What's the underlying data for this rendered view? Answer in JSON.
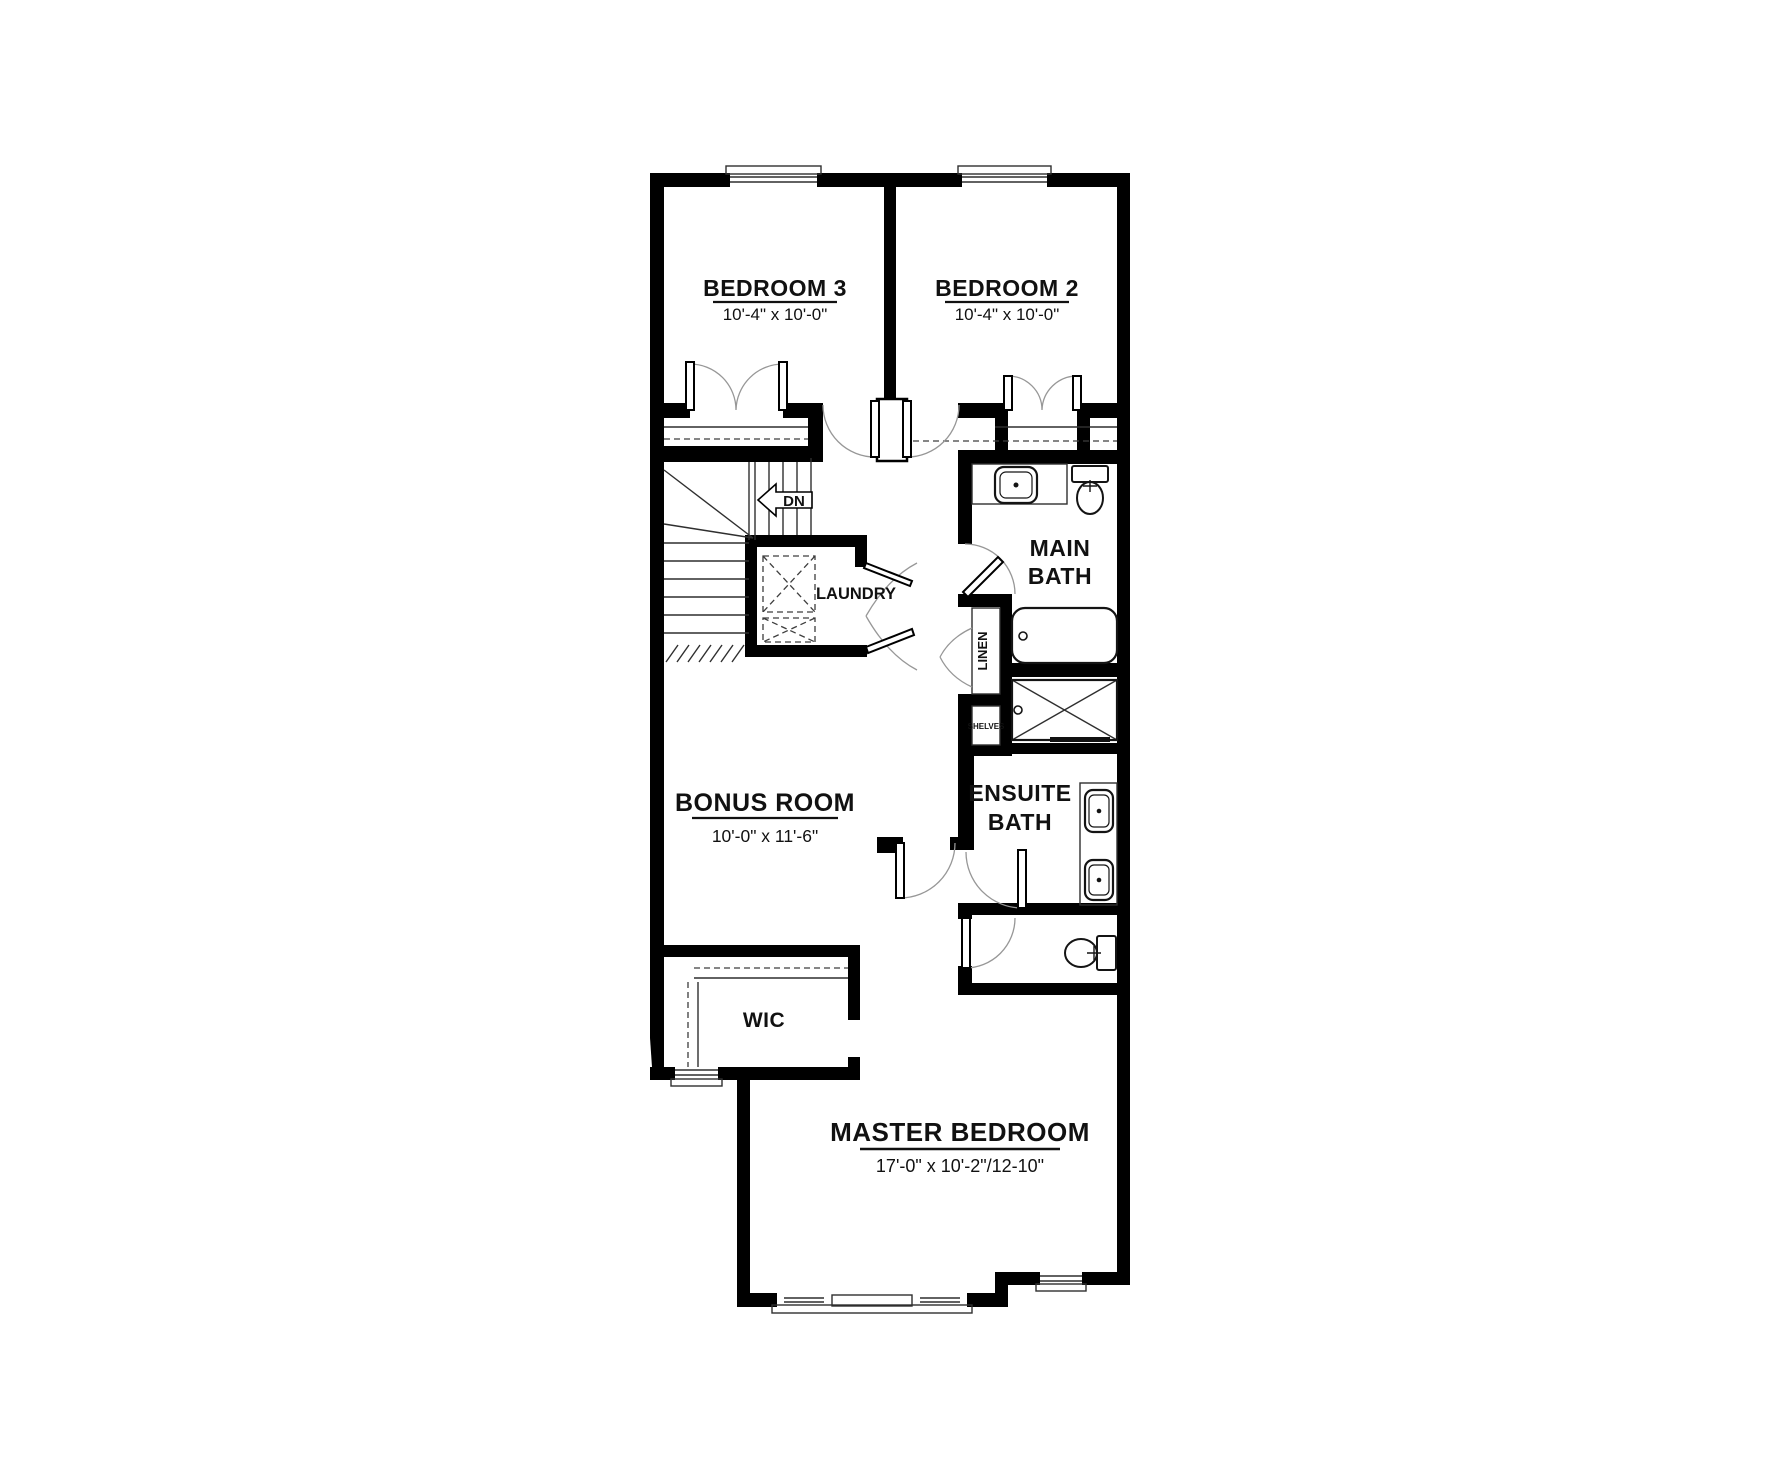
{
  "drawing_type": "residential floor plan - upper level",
  "colors": {
    "wall": "#000000",
    "line": "#2f2f2f",
    "swing": "#979797",
    "dash": "#3d3d3d",
    "text": "#111111",
    "background": "#ffffff"
  },
  "rooms": {
    "bedroom3": {
      "label": "BEDROOM 3",
      "dims": "10'-4\" x 10'-0\""
    },
    "bedroom2": {
      "label": "BEDROOM 2",
      "dims": "10'-4\" x 10'-0\""
    },
    "main_bath": {
      "line1": "MAIN",
      "line2": "BATH"
    },
    "laundry": {
      "label": "LAUNDRY"
    },
    "bonus_room": {
      "label": "BONUS ROOM",
      "dims": "10'-0\" x 11'-6\""
    },
    "ensuite_bath": {
      "line1": "ENSUITE",
      "line2": "BATH"
    },
    "wic": {
      "label": "WIC"
    },
    "master_bedroom": {
      "label": "MASTER BEDROOM",
      "dims": "17'-0\" x 10'-2\"/12-10\""
    }
  },
  "annotations": {
    "stairs_down": "DN",
    "linen": "LINEN",
    "shelves": "SHELVES"
  }
}
